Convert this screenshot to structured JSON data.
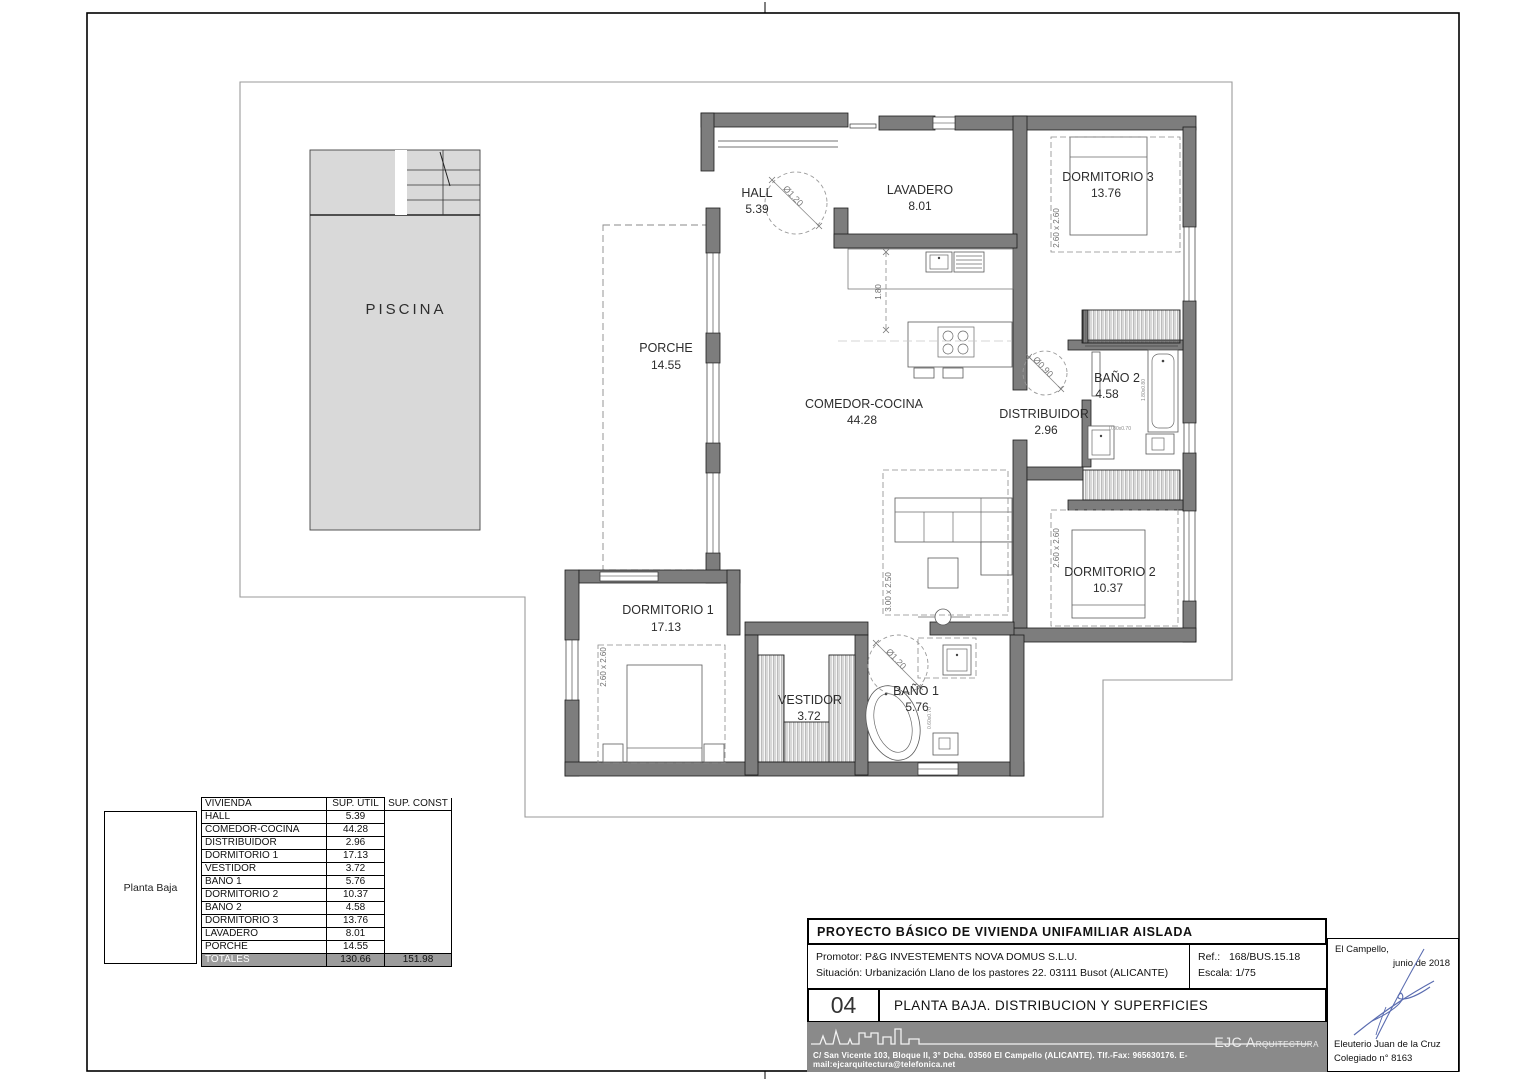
{
  "drawing": {
    "rooms": {
      "piscina": {
        "name": "PISCINA",
        "area": ""
      },
      "porche": {
        "name": "PORCHE",
        "area": "14.55"
      },
      "hall": {
        "name": "HALL",
        "area": "5.39"
      },
      "lavadero": {
        "name": "LAVADERO",
        "area": "8.01"
      },
      "dormitorio3": {
        "name": "DORMITORIO 3",
        "area": "13.76"
      },
      "comedor": {
        "name": "COMEDOR-COCINA",
        "area": "44.28"
      },
      "distribuidor": {
        "name": "DISTRIBUIDOR",
        "area": "2.96"
      },
      "bano2": {
        "name": "BAÑO 2",
        "area": "4.58"
      },
      "dormitorio2": {
        "name": "DORMITORIO 2",
        "area": "10.37"
      },
      "dormitorio1": {
        "name": "DORMITORIO 1",
        "area": "17.13"
      },
      "vestidor": {
        "name": "VESTIDOR",
        "area": "3.72"
      },
      "bano1": {
        "name": "BAÑO 1",
        "area": "5.76"
      }
    },
    "dims": {
      "hall_door": "Ø1.20",
      "distribuidor_door": "Ø0.90",
      "bano1_door": "Ø1.20",
      "kitchen_width": "1.80",
      "dorm3_bed": "2.60 x 2.60",
      "dorm2_bed": "2.60 x 2.60",
      "dorm1_bed": "2.60 x 2.60",
      "living_sofa": "3.00 x 2.50",
      "bano2_tub": "1.80x0.80",
      "bano2_wc": "0.80x0.70",
      "bano1_wc": "0.60x0.70"
    }
  },
  "table": {
    "floor_label": "Planta Baja",
    "col_headers": [
      "VIVIENDA",
      "SUP. ÚTIL",
      "SUP. CONST"
    ],
    "rows": [
      [
        "HALL",
        "5.39"
      ],
      [
        "COMEDOR-COCINA",
        "44.28"
      ],
      [
        "DISTRIBUIDOR",
        "2.96"
      ],
      [
        "DORMITORIO 1",
        "17.13"
      ],
      [
        "VESTIDOR",
        "3.72"
      ],
      [
        "BAÑO 1",
        "5.76"
      ],
      [
        "DORMITORIO 2",
        "10.37"
      ],
      [
        "BAÑO 2",
        "4.58"
      ],
      [
        "DORMITORIO 3",
        "13.76"
      ],
      [
        "LAVADERO",
        "8.01"
      ],
      [
        "PORCHE",
        "14.55"
      ]
    ],
    "totals": {
      "label": "TOTALES",
      "sup_util": "130.66",
      "sup_const": "151.98"
    }
  },
  "titleblock": {
    "project_title": "PROYECTO BÁSICO DE VIVIENDA UNIFAMILIAR AISLADA",
    "promotor_label": "Promotor:",
    "promotor": "P&G INVESTEMENTS NOVA DOMUS S.L.U.",
    "situacion_label": "Situación:",
    "situacion": "Urbanización Llano de los pastores 22. 03111 Busot (ALICANTE)",
    "ref_label": "Ref.:",
    "ref_value": "168/BUS.15.18",
    "escala_label": "Escala:",
    "escala_value": "1/75",
    "plan_number": "04",
    "plan_title": "PLANTA BAJA. DISTRIBUCION Y SUPERFICIES",
    "studio_initials": "EJC A",
    "studio_rest": "RQUITECTURA",
    "studio_address": "C/ San Vicente 103, Bloque II, 3° Dcha. 03560 El Campello (ALICANTE). Tlf.-Fax: 965630176. E-mail:ejcarquitectura@telefonica.net",
    "place": "El Campello,",
    "date": "junio de 2018",
    "architect": "Eleuterio Juan de la Cruz",
    "colegiado": "Colegiado n° 8163"
  }
}
